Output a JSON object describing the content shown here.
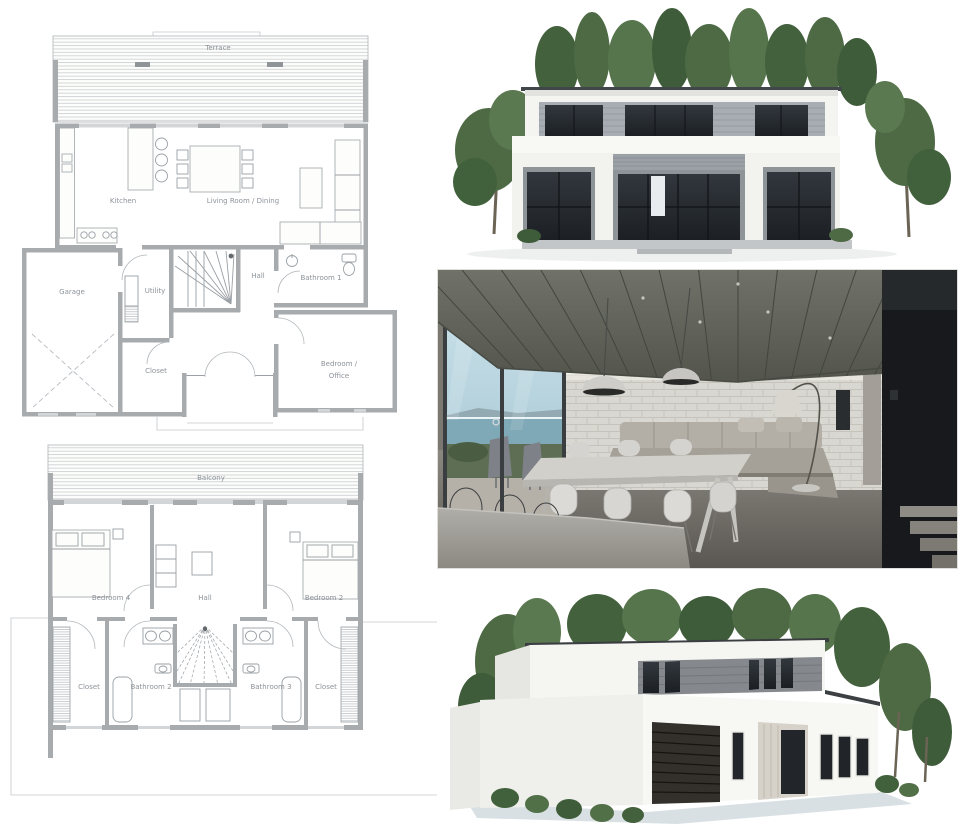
{
  "page": {
    "background": "#ffffff"
  },
  "floor1": {
    "terrace": "Terrace",
    "kitchen": "Kitchen",
    "living": "Living Room / Dining",
    "garage": "Garage",
    "utility": "Utility",
    "hall": "Hall",
    "bathroom1": "Bathroom 1",
    "closet": "Closet",
    "bedroom_office_line1": "Bedroom /",
    "bedroom_office_line2": "Office"
  },
  "floor2": {
    "balcony": "Balcony",
    "bedroom4": "Bedroom 4",
    "hall": "Hall",
    "bedroom2": "Bedroom 2",
    "closet_left": "Closet",
    "bathroom2": "Bathroom 2",
    "bathroom3": "Bathroom 3",
    "closet_right": "Closet"
  },
  "colors": {
    "plan_wall": "#a7abae",
    "plan_line": "#9aa0a5",
    "plan_text": "#8d9399",
    "plan_hatch": "#c9ccd0",
    "house_white": "#f4f4f1",
    "window_dark": "#22262a",
    "tree_green": "#4d6a45",
    "interior_ceiling": "#63665e",
    "interior_sky": "#bcd8e2",
    "interior_sea": "#7fa9b7",
    "ground_shadow": "#ccd5da"
  }
}
